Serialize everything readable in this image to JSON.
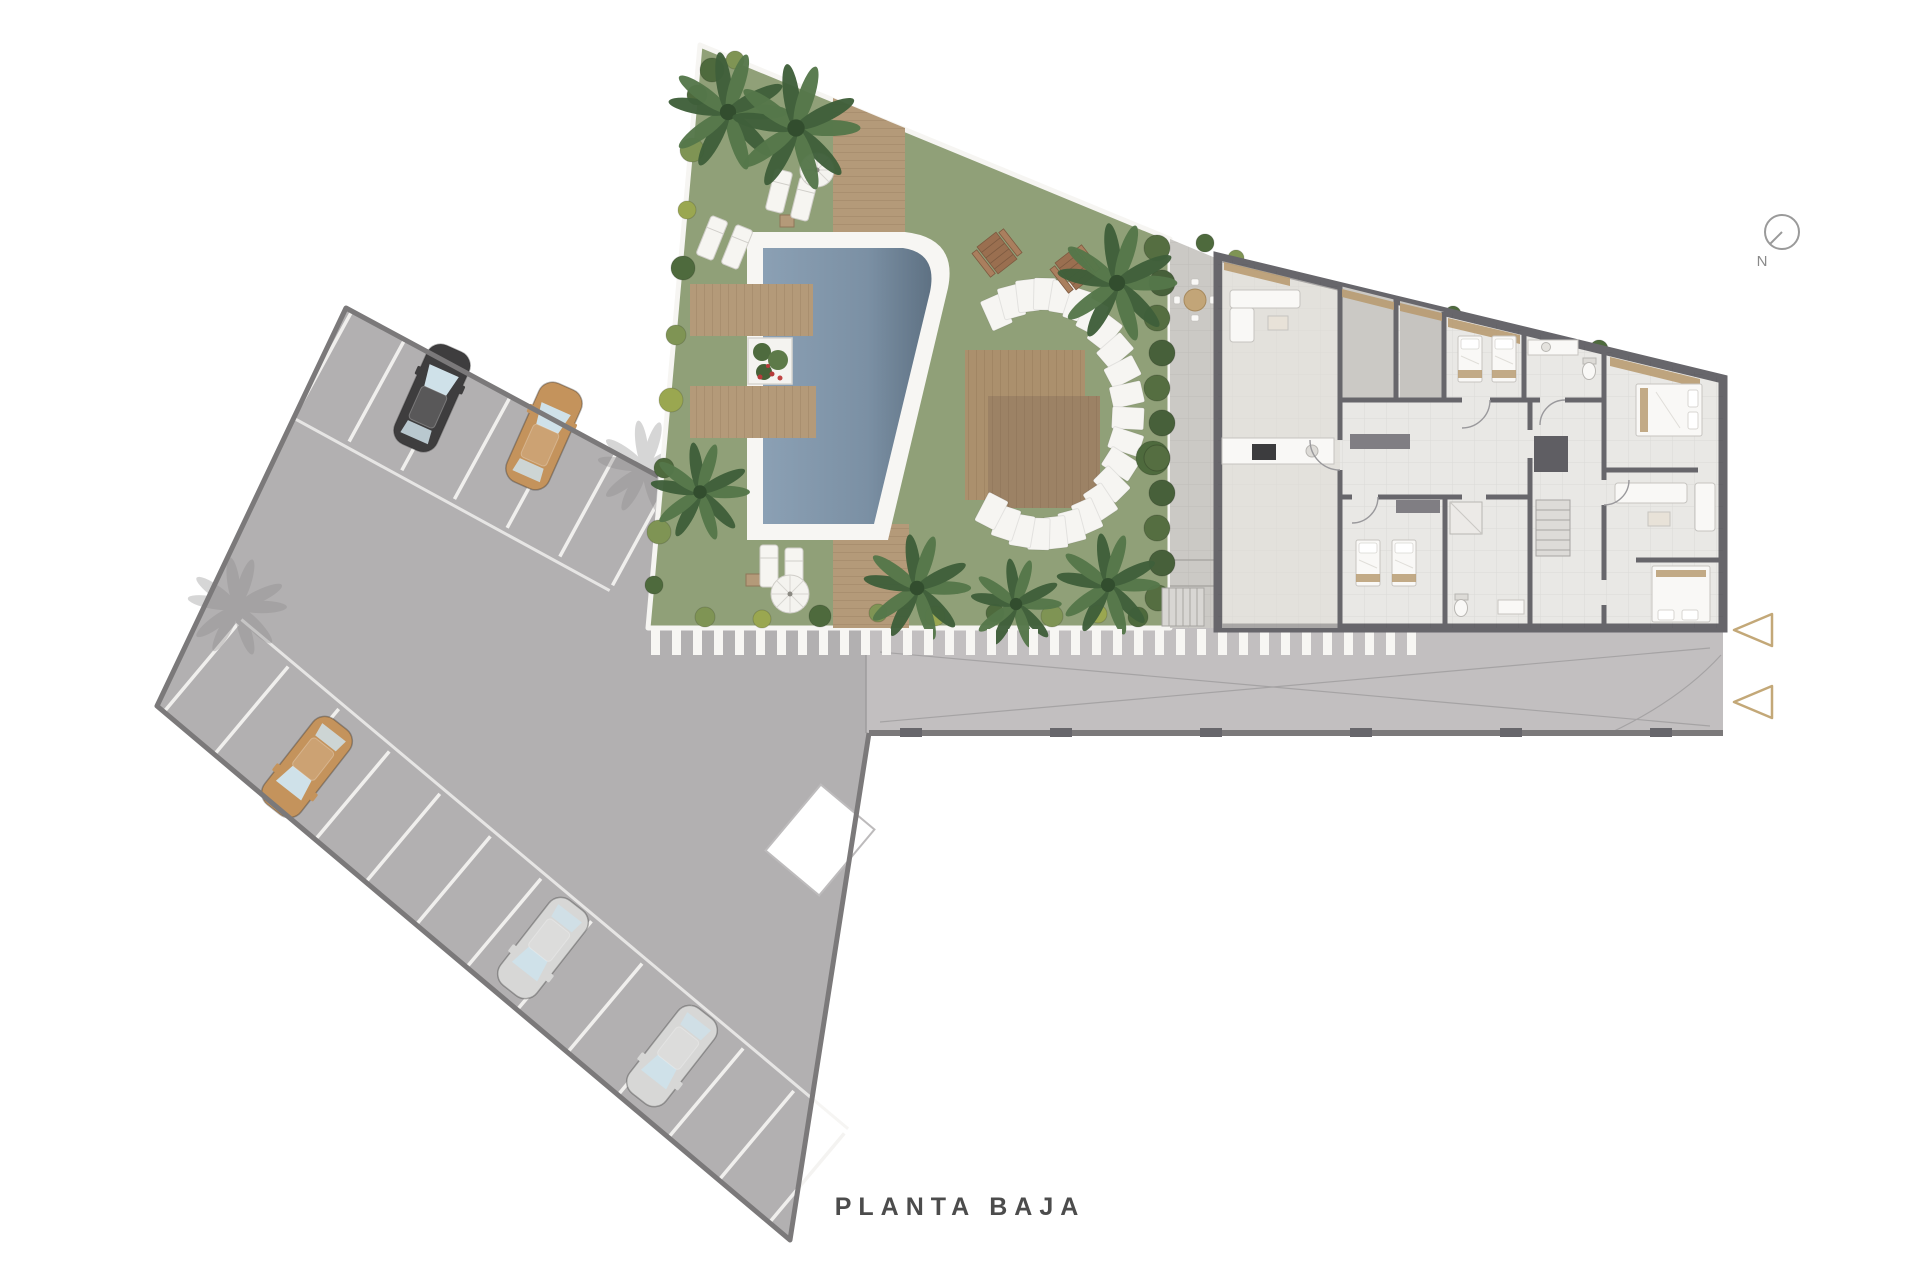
{
  "title": "PLANTA BAJA",
  "compass": {
    "label": "N"
  },
  "colors": {
    "background": "#ffffff",
    "asphalt": "#b2b0b1",
    "asphalt_light": "#c3c1c2",
    "lot_border": "#7b797a",
    "stall_line": "#f4f3f1",
    "grass": "#90a078",
    "grass_edge": "#f6f5f2",
    "wood": "#b49a79",
    "wood_dark": "#9c8265",
    "pool_rim": "#f7f6f3",
    "pool_water": "#8a9fb3",
    "pool_water_deep": "#5e7183",
    "building_floor": "#e9e8e5",
    "terrace_floor": "#cbc9c5",
    "wall": "#67666b",
    "hedge_dark": "#47603a",
    "hedge_light": "#556e41",
    "palm_light": "#55774a",
    "palm_dark": "#3f5f3a",
    "palm_center": "#2f4a2c",
    "bush_dark": "#4e6a3d",
    "bush_light": "#7f9454",
    "bush_yellow": "#9aa750",
    "shadow_gray": "#8d8b8c",
    "furniture": "#f9f8f6",
    "furniture_stroke": "#c6c4c0",
    "accent_tan": "#b99c72",
    "bench_wood": "#9a6f50",
    "glass": "#cfe1e9",
    "arrow": "#c3a878",
    "compass_stroke": "#9a9a9a",
    "text": "#4c4c4c",
    "stripe": "#f7f6f3"
  },
  "parking": {
    "cars": [
      {
        "x": 432,
        "y": 398,
        "rot": 24,
        "color": "#3e3d3e"
      },
      {
        "x": 544,
        "y": 436,
        "rot": 24,
        "color": "#c4935c"
      },
      {
        "x": 307,
        "y": 767,
        "rot": 218,
        "color": "#c4935c"
      },
      {
        "x": 543,
        "y": 948,
        "rot": 218,
        "color": "#d7d7d6"
      },
      {
        "x": 672,
        "y": 1056,
        "rot": 218,
        "color": "#d7d7d6"
      }
    ],
    "stall_rows": [
      {
        "x": 352,
        "y": 311,
        "dx": 0.878,
        "dy": 0.479,
        "nx": -0.479,
        "ny": 0.878,
        "count": 7,
        "spacing": 60,
        "depth": 116,
        "aisle": 122,
        "aisle_len": 360
      },
      {
        "x": 163,
        "y": 713,
        "dx": 0.766,
        "dy": 0.643,
        "nx": 0.643,
        "ny": -0.766,
        "count": 13,
        "spacing": 66,
        "depth": 116,
        "aisle": 122,
        "aisle_len": 792
      }
    ],
    "shadow_palms": [
      [
        645,
        468,
        46
      ],
      [
        237,
        607,
        48
      ]
    ]
  },
  "landscape": {
    "palms": [
      [
        728,
        112,
        58
      ],
      [
        796,
        128,
        62
      ],
      [
        700,
        492,
        48
      ],
      [
        917,
        588,
        52
      ],
      [
        1016,
        604,
        44
      ],
      [
        1108,
        585,
        50
      ],
      [
        1117,
        283,
        58
      ]
    ],
    "bushes": [
      [
        697,
        95,
        10,
        "d"
      ],
      [
        692,
        150,
        12,
        "l"
      ],
      [
        687,
        210,
        9,
        "y"
      ],
      [
        683,
        268,
        12,
        "d"
      ],
      [
        676,
        335,
        10,
        "l"
      ],
      [
        671,
        400,
        12,
        "y"
      ],
      [
        664,
        468,
        10,
        "d"
      ],
      [
        659,
        532,
        12,
        "l"
      ],
      [
        654,
        585,
        9,
        "d"
      ],
      [
        705,
        617,
        10,
        "l"
      ],
      [
        762,
        619,
        9,
        "y"
      ],
      [
        820,
        616,
        11,
        "d"
      ],
      [
        878,
        613,
        9,
        "l"
      ],
      [
        935,
        616,
        10,
        "y"
      ],
      [
        995,
        613,
        9,
        "d"
      ],
      [
        1052,
        616,
        11,
        "l"
      ],
      [
        1098,
        614,
        9,
        "y"
      ],
      [
        1138,
        617,
        10,
        "d"
      ],
      [
        712,
        70,
        12,
        "d"
      ],
      [
        735,
        60,
        9,
        "l"
      ],
      [
        1205,
        243,
        9,
        "d"
      ],
      [
        1236,
        258,
        8,
        "l"
      ],
      [
        1453,
        314,
        8,
        "d"
      ],
      [
        1599,
        349,
        9,
        "d"
      ],
      [
        1713,
        420,
        9,
        "l"
      ],
      [
        1153,
        458,
        17,
        "d"
      ]
    ],
    "hedge": [
      [
        1157,
        248,
        13
      ],
      [
        1162,
        283,
        13
      ],
      [
        1157,
        318,
        13
      ],
      [
        1162,
        353,
        13
      ],
      [
        1157,
        388,
        13
      ],
      [
        1162,
        423,
        13
      ],
      [
        1157,
        458,
        13
      ],
      [
        1162,
        493,
        13
      ],
      [
        1157,
        528,
        13
      ],
      [
        1162,
        563,
        13
      ],
      [
        1158,
        598,
        13
      ]
    ],
    "loungers": [
      [
        779,
        191,
        14
      ],
      [
        804,
        199,
        14
      ],
      [
        712,
        238,
        22
      ],
      [
        737,
        247,
        22
      ],
      [
        769,
        566,
        0
      ],
      [
        794,
        569,
        0
      ]
    ],
    "side_tables": [
      [
        787,
        221
      ],
      [
        753,
        580
      ]
    ],
    "parasols": [
      [
        817,
        170,
        17
      ],
      [
        790,
        594,
        19
      ]
    ],
    "picnic_tables": [
      [
        997,
        253,
        -38
      ],
      [
        1075,
        269,
        -38
      ]
    ],
    "round_tables": [
      [
        1195,
        300,
        11
      ],
      [
        1366,
        352,
        9
      ],
      [
        1420,
        356,
        8
      ],
      [
        1285,
        357,
        18
      ],
      [
        1655,
        518,
        14
      ]
    ],
    "stepping_stones": {
      "cx": 1042,
      "cy": 414,
      "rx": 86,
      "ry": 120,
      "start": -122,
      "end": 126,
      "count": 23,
      "w": 22,
      "h": 32
    }
  },
  "entrance_arrows": [
    {
      "x": 1753,
      "y": 630
    },
    {
      "x": 1753,
      "y": 702
    }
  ]
}
